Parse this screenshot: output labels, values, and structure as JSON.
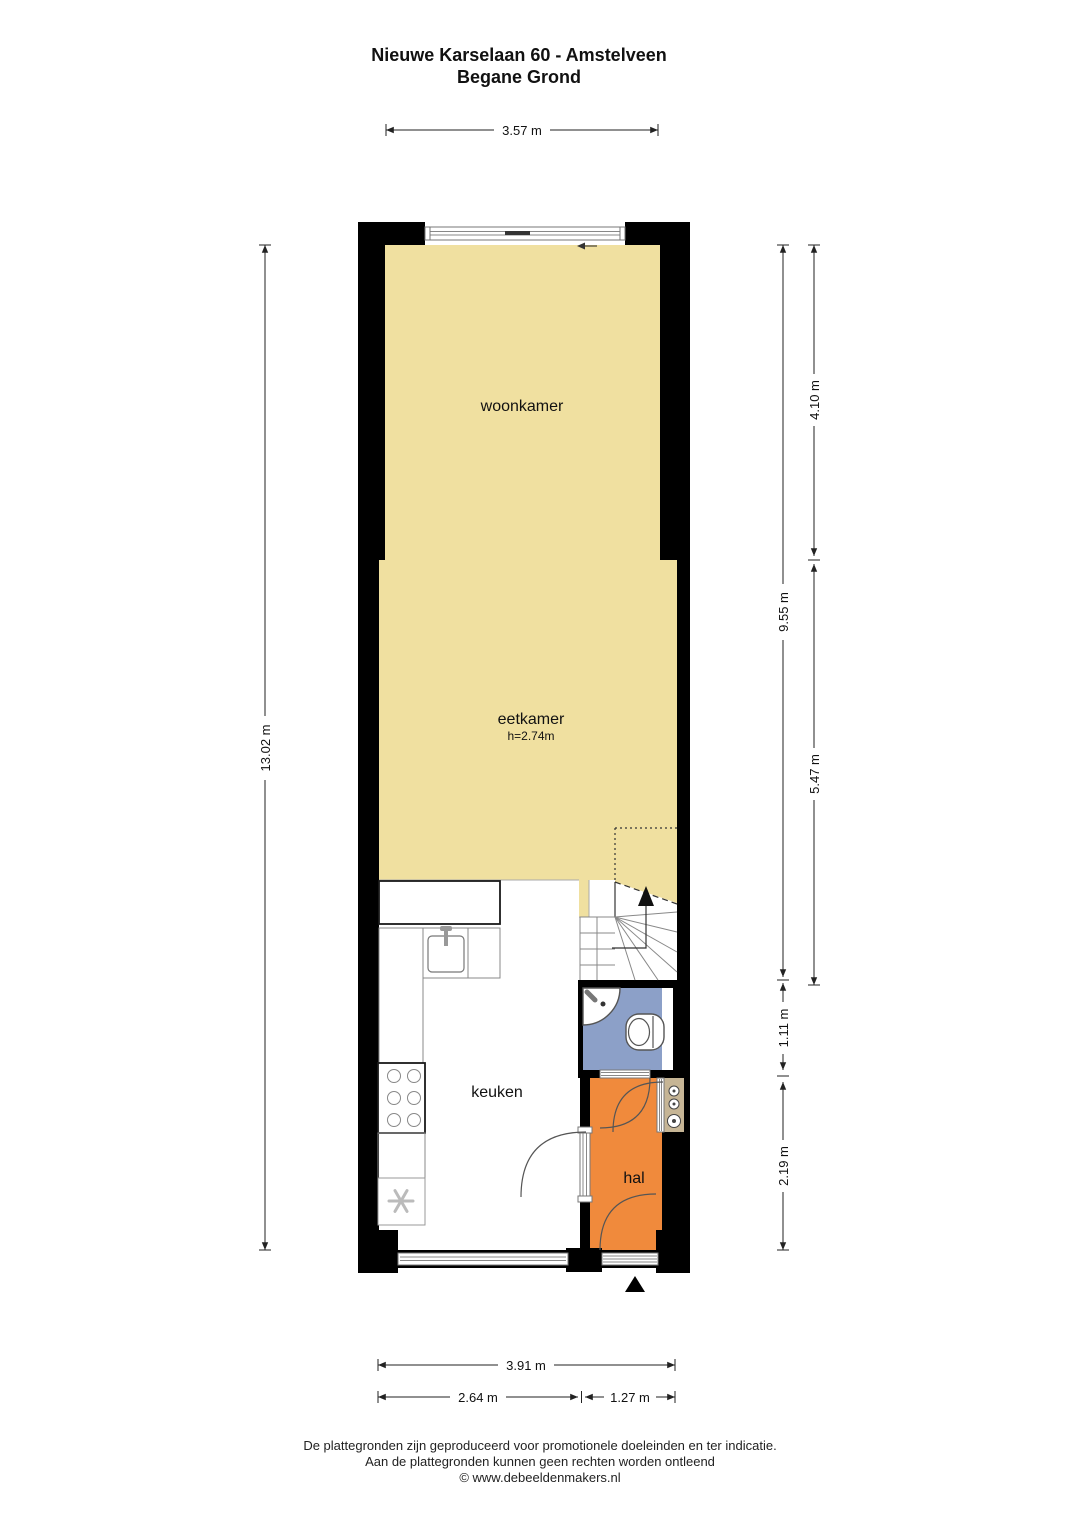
{
  "title": {
    "line1": "Nieuwe Karselaan 60 - Amstelveen",
    "line2": "Begane Grond"
  },
  "rooms": {
    "woonkamer": "woonkamer",
    "eetkamer": "eetkamer",
    "eetkamer_height": "h=2.74m",
    "keuken": "keuken",
    "hal": "hal"
  },
  "dimensions": {
    "top_width": "3.57 m",
    "left_total": "13.02 m",
    "right_woonkamer": "4.10 m",
    "right_upper_total": "9.55 m",
    "right_eetkamer": "5.47 m",
    "right_toilet": "1.11 m",
    "right_hal": "2.19 m",
    "bottom_total": "3.91 m",
    "bottom_keuken": "2.64 m",
    "bottom_hal": "1.27 m"
  },
  "footer": {
    "line1": "De plattegronden zijn geproduceerd voor promotionele doeleinden en ter indicatie.",
    "line2": "Aan de plattegronden kunnen geen rechten worden ontleend",
    "line3": "© www.debeeldenmakers.nl"
  },
  "colors": {
    "room_yellow": "#F0E0A0",
    "toilet_blue": "#8CA0C8",
    "hal_orange": "#F08A3C",
    "meterkast_tan": "#C6B595",
    "wall": "#000000"
  }
}
